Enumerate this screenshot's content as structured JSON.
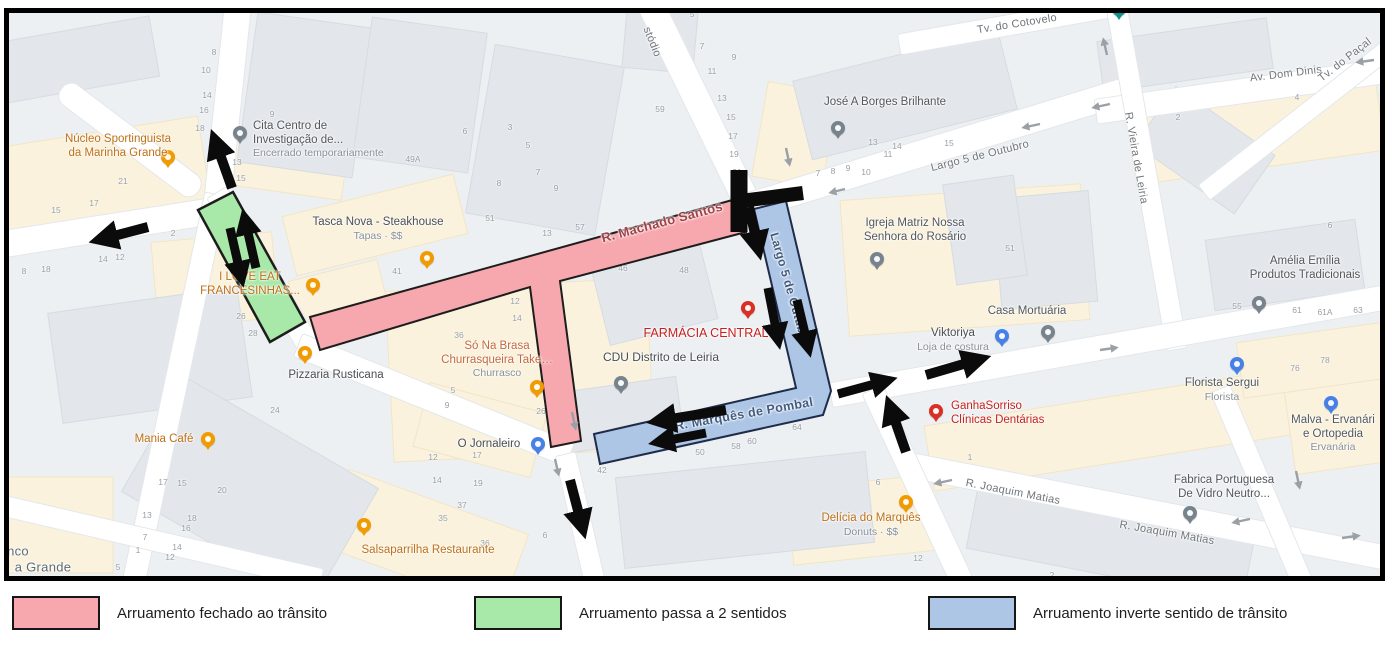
{
  "legend": {
    "items": [
      {
        "label": "Arruamento fechado ao trânsito",
        "color": "#f7a8ae",
        "x": 12
      },
      {
        "label": "Arruamento passa a 2 sentidos",
        "color": "#a8e8a8",
        "x": 474
      },
      {
        "label": "Arruamento inverte sentido de trânsito",
        "color": "#adc6e6",
        "x": 928
      }
    ]
  },
  "colors": {
    "road_closed": "#f7a8ae",
    "road_two_way": "#a8e8a8",
    "road_inverted": "#adc6e6",
    "annotation_black": "#0b0b0b",
    "band_outline": "#1d1d1d",
    "blue_band_outline": "#1f2c49"
  },
  "map": {
    "pois": [
      {
        "id": "nucleo-sportinguista",
        "lines": [
          "Núcleo Sportinguista",
          "da Marinha Grande"
        ],
        "color": "#bf7017",
        "pin": {
          "x": 168,
          "y": 164,
          "color": "#f29b00",
          "icon": "bar-pin-icon"
        },
        "text": {
          "x": 118,
          "y": 133
        }
      },
      {
        "id": "cita-centro",
        "lines": [
          "Cita Centro de",
          "Investigação de..."
        ],
        "sub": "Encerrado temporariamente",
        "color": "#53575c",
        "align": "left",
        "pin": {
          "x": 240,
          "y": 140,
          "color": "#78848d",
          "icon": "place-pin-icon"
        },
        "text": {
          "x": 253,
          "y": 120
        }
      },
      {
        "id": "tasca-nova",
        "lines": [
          "Tasca Nova - Steakhouse"
        ],
        "sub": "Tapas · $$",
        "color": "#4a4e52",
        "pin": {
          "x": 427,
          "y": 265,
          "color": "#f29b00",
          "icon": "restaurant-pin-icon"
        },
        "text": {
          "x": 378,
          "y": 216
        }
      },
      {
        "id": "i-love-eat",
        "lines": [
          "I LOVE EAT",
          "FRANCESINHAS..."
        ],
        "color": "#bf7017",
        "pin": {
          "x": 313,
          "y": 292,
          "color": "#f29b00",
          "icon": "restaurant-pin-icon"
        },
        "text": {
          "x": 250,
          "y": 271
        }
      },
      {
        "id": "pizzaria-rusticana",
        "lines": [
          "Pizzaria Rusticana"
        ],
        "color": "#4a4e52",
        "pin": {
          "x": 305,
          "y": 360,
          "color": "#f29b00",
          "icon": "restaurant-pin-icon"
        },
        "text": {
          "x": 336,
          "y": 369
        }
      },
      {
        "id": "mania-cafe",
        "lines": [
          "Mania Café"
        ],
        "color": "#bf7017",
        "pin": {
          "x": 208,
          "y": 446,
          "color": "#f29b00",
          "icon": "cafe-pin-icon"
        },
        "text": {
          "x": 164,
          "y": 433
        }
      },
      {
        "id": "so-na-brasa",
        "lines": [
          "Só Na Brasa",
          "Churrasqueira Take…"
        ],
        "sub": "Churrasco",
        "color": "#c4693d",
        "pin": {
          "x": 537,
          "y": 394,
          "color": "#f29b00",
          "icon": "restaurant-pin-icon"
        },
        "text": {
          "x": 497,
          "y": 340
        }
      },
      {
        "id": "o-jornaleiro",
        "lines": [
          "O Jornaleiro"
        ],
        "color": "#4a4e52",
        "pin": {
          "x": 538,
          "y": 451,
          "color": "#4781e8",
          "icon": "shopping-pin-icon"
        },
        "text": {
          "x": 489,
          "y": 438
        }
      },
      {
        "id": "salsaparrilha",
        "lines": [
          "Salsaparrilha Restaurante"
        ],
        "color": "#bf7017",
        "pin": {
          "x": 364,
          "y": 532,
          "color": "#f29b00",
          "icon": "restaurant-pin-icon"
        },
        "text": {
          "x": 428,
          "y": 544
        }
      },
      {
        "id": "farmacia-central",
        "lines": [
          "FARMÁCIA CENTRAL"
        ],
        "color": "#c5221f",
        "size": 12.5,
        "pin": {
          "x": 748,
          "y": 315,
          "color": "#d93025",
          "icon": "pharmacy-pin-icon"
        },
        "text": {
          "x": 706,
          "y": 326
        }
      },
      {
        "id": "cdu-leiria",
        "lines": [
          "CDU Distrito de Leiria"
        ],
        "color": "#4a4e52",
        "size": 12,
        "pin": {
          "x": 621,
          "y": 390,
          "color": "#78848d",
          "icon": "place-pin-icon"
        },
        "text": {
          "x": 661,
          "y": 350
        }
      },
      {
        "id": "jose-borges",
        "lines": [
          "José A Borges Brilhante"
        ],
        "color": "#53575c",
        "pin": {
          "x": 838,
          "y": 135,
          "color": "#78848d",
          "icon": "place-pin-icon"
        },
        "text": {
          "x": 885,
          "y": 96
        }
      },
      {
        "id": "igreja-matriz",
        "lines": [
          "Igreja Matriz Nossa",
          "Senhora do Rosário"
        ],
        "color": "#53575c",
        "pin": {
          "x": 877,
          "y": 266,
          "color": "#78848d",
          "icon": "church-pin-icon"
        },
        "text": {
          "x": 915,
          "y": 217
        }
      },
      {
        "id": "casa-mortuaria",
        "lines": [
          "Casa Mortuária"
        ],
        "color": "#53575c",
        "pin": {
          "x": 1048,
          "y": 339,
          "color": "#78848d",
          "icon": "place-pin-icon"
        },
        "text": {
          "x": 1027,
          "y": 305
        }
      },
      {
        "id": "viktoriya",
        "lines": [
          "Viktoriya"
        ],
        "sub": "Loja de costura",
        "color": "#4a4e52",
        "pin": {
          "x": 1002,
          "y": 343,
          "color": "#4781e8",
          "icon": "shopping-pin-icon"
        },
        "text": {
          "x": 953,
          "y": 327
        }
      },
      {
        "id": "florista-sergui",
        "lines": [
          "Florista Sergui"
        ],
        "sub": "Florista",
        "color": "#53575c",
        "pin": {
          "x": 1237,
          "y": 371,
          "color": "#4781e8",
          "icon": "florist-pin-icon"
        },
        "text": {
          "x": 1222,
          "y": 377
        }
      },
      {
        "id": "malva-ervanaria",
        "lines": [
          "Malva - Ervanári",
          "e Ortopedia"
        ],
        "sub": "Ervanária",
        "color": "#53575c",
        "pin": {
          "x": 1331,
          "y": 410,
          "color": "#4781e8",
          "icon": "shopping-pin-icon"
        },
        "text": {
          "x": 1333,
          "y": 414
        }
      },
      {
        "id": "amelia-emilia",
        "lines": [
          "Amélia Emília",
          "Produtos Tradicionais"
        ],
        "color": "#53575c",
        "pin": {
          "x": 1259,
          "y": 310,
          "color": "#78848d",
          "icon": "place-pin-icon"
        },
        "text": {
          "x": 1305,
          "y": 255
        }
      },
      {
        "id": "ganhasorriso",
        "lines": [
          "GanhaSorriso",
          "Clínicas Dentárias"
        ],
        "color": "#c5221f",
        "align": "left",
        "pin": {
          "x": 936,
          "y": 418,
          "color": "#d93025",
          "icon": "dentist-pin-icon"
        },
        "text": {
          "x": 951,
          "y": 400
        }
      },
      {
        "id": "fabrica-vidro",
        "lines": [
          "Fabrica Portuguesa",
          "De Vidro Neutro..."
        ],
        "color": "#53575c",
        "pin": {
          "x": 1190,
          "y": 520,
          "color": "#78848d",
          "icon": "place-pin-icon"
        },
        "text": {
          "x": 1224,
          "y": 474
        }
      },
      {
        "id": "delicia-marques",
        "lines": [
          "Delícia do Marquês"
        ],
        "sub": "Donuts · $$",
        "color": "#bf7017",
        "pin": {
          "x": 906,
          "y": 509,
          "color": "#f29b00",
          "icon": "restaurant-pin-icon"
        },
        "text": {
          "x": 871,
          "y": 512
        }
      },
      {
        "id": "teal-poi",
        "lines": [],
        "color": "#12918b",
        "pin": {
          "x": 1119,
          "y": 16,
          "color": "#12918b",
          "icon": "attraction-pin-icon"
        },
        "text": {
          "x": 1119,
          "y": 16
        }
      }
    ],
    "street_labels": [
      {
        "text": "stódio",
        "x": 652,
        "y": 42,
        "rot": 68
      },
      {
        "text": "Tv. do Cotovelo",
        "x": 1017,
        "y": 24,
        "rot": -9
      },
      {
        "text": "Av. Dom Dinis",
        "x": 1286,
        "y": 74,
        "rot": -7
      },
      {
        "text": "Largo 5 de Outubro",
        "x": 980,
        "y": 156,
        "rot": -14
      },
      {
        "text": "R. Vieira de Leiria",
        "x": 1136,
        "y": 158,
        "rot": 80
      },
      {
        "text": "Tv. do Paçal",
        "x": 1345,
        "y": 60,
        "rot": -38
      },
      {
        "text": "R. Machado Santos",
        "x": 662,
        "y": 222,
        "rot": -15,
        "color": "#9c4147",
        "size": 13,
        "bold": true
      },
      {
        "text": "Largo 5 de Outubro",
        "x": 790,
        "y": 289,
        "rot": 74,
        "color": "#415a7d",
        "size": 12,
        "bold": true
      },
      {
        "text": "R. Marquês de Pombal",
        "x": 744,
        "y": 414,
        "rot": -10,
        "color": "#415a7d",
        "size": 12.5,
        "bold": true
      },
      {
        "text": "R. Joaquim Matias",
        "x": 1013,
        "y": 492,
        "rot": 11
      },
      {
        "text": "R. Joaquim Matias",
        "x": 1167,
        "y": 533,
        "rot": 10
      },
      {
        "text": "nco",
        "x": 18,
        "y": 551,
        "rot": 0,
        "color": "#5d6b7b",
        "size": 13
      },
      {
        "text": "a Grande",
        "x": 43,
        "y": 567,
        "rot": 0,
        "color": "#5d6b7b",
        "size": 13
      }
    ],
    "house_numbers": [
      [
        "8",
        214,
        52
      ],
      [
        "10",
        206,
        70
      ],
      [
        "14",
        207,
        95
      ],
      [
        "16",
        204,
        110
      ],
      [
        "18",
        200,
        128
      ],
      [
        "9",
        272,
        114
      ],
      [
        "13",
        237,
        162
      ],
      [
        "15",
        241,
        178
      ],
      [
        "21",
        123,
        181
      ],
      [
        "17",
        94,
        203
      ],
      [
        "15",
        56,
        210
      ],
      [
        "49A",
        413,
        159
      ],
      [
        "59",
        660,
        109
      ],
      [
        "5",
        692,
        14
      ],
      [
        "7",
        702,
        46
      ],
      [
        "9",
        734,
        57
      ],
      [
        "11",
        712,
        71
      ],
      [
        "13",
        722,
        98
      ],
      [
        "15",
        731,
        117
      ],
      [
        "17",
        733,
        136
      ],
      [
        "19",
        734,
        154
      ],
      [
        "21",
        737,
        172
      ],
      [
        "3",
        510,
        127
      ],
      [
        "5",
        528,
        145
      ],
      [
        "7",
        538,
        172
      ],
      [
        "9",
        556,
        188
      ],
      [
        "6",
        465,
        131
      ],
      [
        "8",
        499,
        183
      ],
      [
        "6",
        6,
        268
      ],
      [
        "8",
        24,
        271
      ],
      [
        "18",
        46,
        269
      ],
      [
        "14",
        103,
        259
      ],
      [
        "12",
        120,
        257
      ],
      [
        "2",
        173,
        233
      ],
      [
        "13",
        873,
        142
      ],
      [
        "14",
        897,
        146
      ],
      [
        "11",
        888,
        154
      ],
      [
        "7",
        818,
        173
      ],
      [
        "8",
        833,
        171
      ],
      [
        "9",
        848,
        168
      ],
      [
        "10",
        866,
        172
      ],
      [
        "15",
        949,
        143
      ],
      [
        "51",
        490,
        218
      ],
      [
        "57",
        580,
        227
      ],
      [
        "13",
        547,
        233
      ],
      [
        "41",
        397,
        271
      ],
      [
        "38",
        478,
        294
      ],
      [
        "40",
        499,
        290
      ],
      [
        "12",
        515,
        301
      ],
      [
        "15",
        549,
        302
      ],
      [
        "14",
        517,
        318
      ],
      [
        "17",
        559,
        321
      ],
      [
        "36",
        459,
        335
      ],
      [
        "46",
        623,
        268
      ],
      [
        "48",
        684,
        270
      ],
      [
        "26",
        241,
        316
      ],
      [
        "28",
        253,
        333
      ],
      [
        "24",
        275,
        410
      ],
      [
        "5",
        453,
        390
      ],
      [
        "9",
        447,
        405
      ],
      [
        "26",
        541,
        411
      ],
      [
        "12",
        433,
        457
      ],
      [
        "14",
        437,
        480
      ],
      [
        "17",
        477,
        455
      ],
      [
        "19",
        478,
        483
      ],
      [
        "37",
        462,
        505
      ],
      [
        "35",
        443,
        518
      ],
      [
        "36",
        485,
        543
      ],
      [
        "6",
        545,
        535
      ],
      [
        "42",
        602,
        470
      ],
      [
        "50",
        700,
        452
      ],
      [
        "58",
        736,
        446
      ],
      [
        "60",
        752,
        441
      ],
      [
        "64",
        797,
        427
      ],
      [
        "17",
        163,
        482
      ],
      [
        "15",
        182,
        483
      ],
      [
        "20",
        222,
        490
      ],
      [
        "13",
        147,
        515
      ],
      [
        "18",
        192,
        518
      ],
      [
        "16",
        186,
        528
      ],
      [
        "7",
        145,
        537
      ],
      [
        "14",
        177,
        547
      ],
      [
        "1",
        138,
        550
      ],
      [
        "12",
        170,
        557
      ],
      [
        "5",
        118,
        567
      ],
      [
        "51",
        1010,
        248
      ],
      [
        "55",
        1237,
        306
      ],
      [
        "61",
        1297,
        310
      ],
      [
        "61A",
        1325,
        312
      ],
      [
        "63",
        1358,
        310
      ],
      [
        "76",
        1295,
        368
      ],
      [
        "78",
        1325,
        360
      ],
      [
        "6",
        1330,
        225
      ],
      [
        "4",
        1297,
        97
      ],
      [
        "2",
        1178,
        117
      ],
      [
        "2",
        1052,
        575
      ],
      [
        "12",
        918,
        558
      ],
      [
        "1",
        970,
        457
      ],
      [
        "6",
        878,
        482
      ]
    ]
  }
}
